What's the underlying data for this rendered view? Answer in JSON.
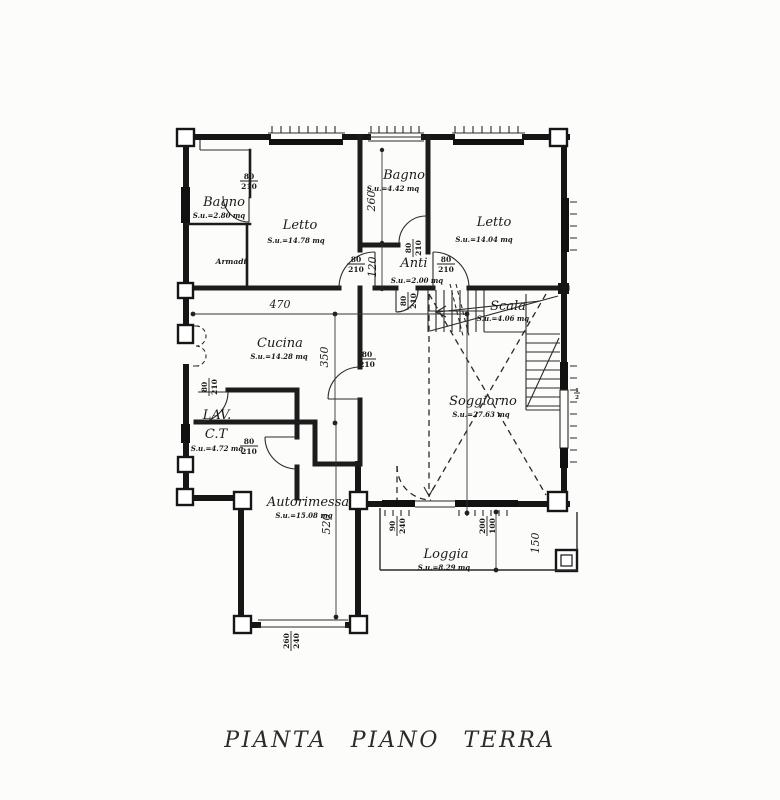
{
  "title": {
    "text": "PIANTA PIANO TERRA"
  },
  "rooms": {
    "bagno_tl": {
      "name": "Bagno",
      "area": "S.u.=2.80 mq"
    },
    "letto_l": {
      "name": "Letto",
      "area": "S.u.=14.78 mq"
    },
    "armadi": {
      "name": "Armadi"
    },
    "bagno_m": {
      "name": "Bagno",
      "area": "S.u.=4.42 mq"
    },
    "letto_r": {
      "name": "Letto",
      "area": "S.u.=14.04 mq"
    },
    "anti": {
      "name": "Anti",
      "area": "S.u.=2.00 mq"
    },
    "scala": {
      "name": "Scala",
      "area": "S.u.=4.06 mq"
    },
    "cucina": {
      "name": "Cucina",
      "area": "S.u.=14.28 mq"
    },
    "lav": {
      "name": "LAV.",
      "name2": "C.T",
      "area": "S.u.=4.72 mq"
    },
    "soggiorno": {
      "name": "Soggiorno",
      "area": "S.u.=27.63 mq"
    },
    "autorimessa": {
      "name": "Autorimessa",
      "area": "S.u.=15.08 mq"
    },
    "loggia": {
      "name": "Loggia",
      "area": "S.u.=8.29 mq"
    }
  },
  "dims": {
    "cucina_width": "470",
    "cucina_depth": "350",
    "garage_depth": "520",
    "bagno_m_depth": "260",
    "anti_depth": "120",
    "loggia_depth": "150"
  },
  "openings": {
    "bagno_tl": {
      "w": "80",
      "h": "210"
    },
    "bagno_m": {
      "w": "80",
      "h": "210"
    },
    "anti_left": {
      "w": "80",
      "h": "210"
    },
    "anti_right": {
      "w": "80",
      "h": "210"
    },
    "anti_bottom": {
      "w": "80",
      "h": "210"
    },
    "cucina": {
      "w": "80",
      "h": "210"
    },
    "lav_top": {
      "w": "80",
      "h": "210"
    },
    "lav_side": {
      "w": "80",
      "h": "210"
    },
    "loggia_win_left": {
      "w": "90",
      "h": "240"
    },
    "loggia_win_right": {
      "w": "200",
      "h": "100"
    },
    "garage_door": {
      "w": "260",
      "h": "240"
    },
    "window_mark": {
      "w": "1",
      "h": "2"
    }
  }
}
